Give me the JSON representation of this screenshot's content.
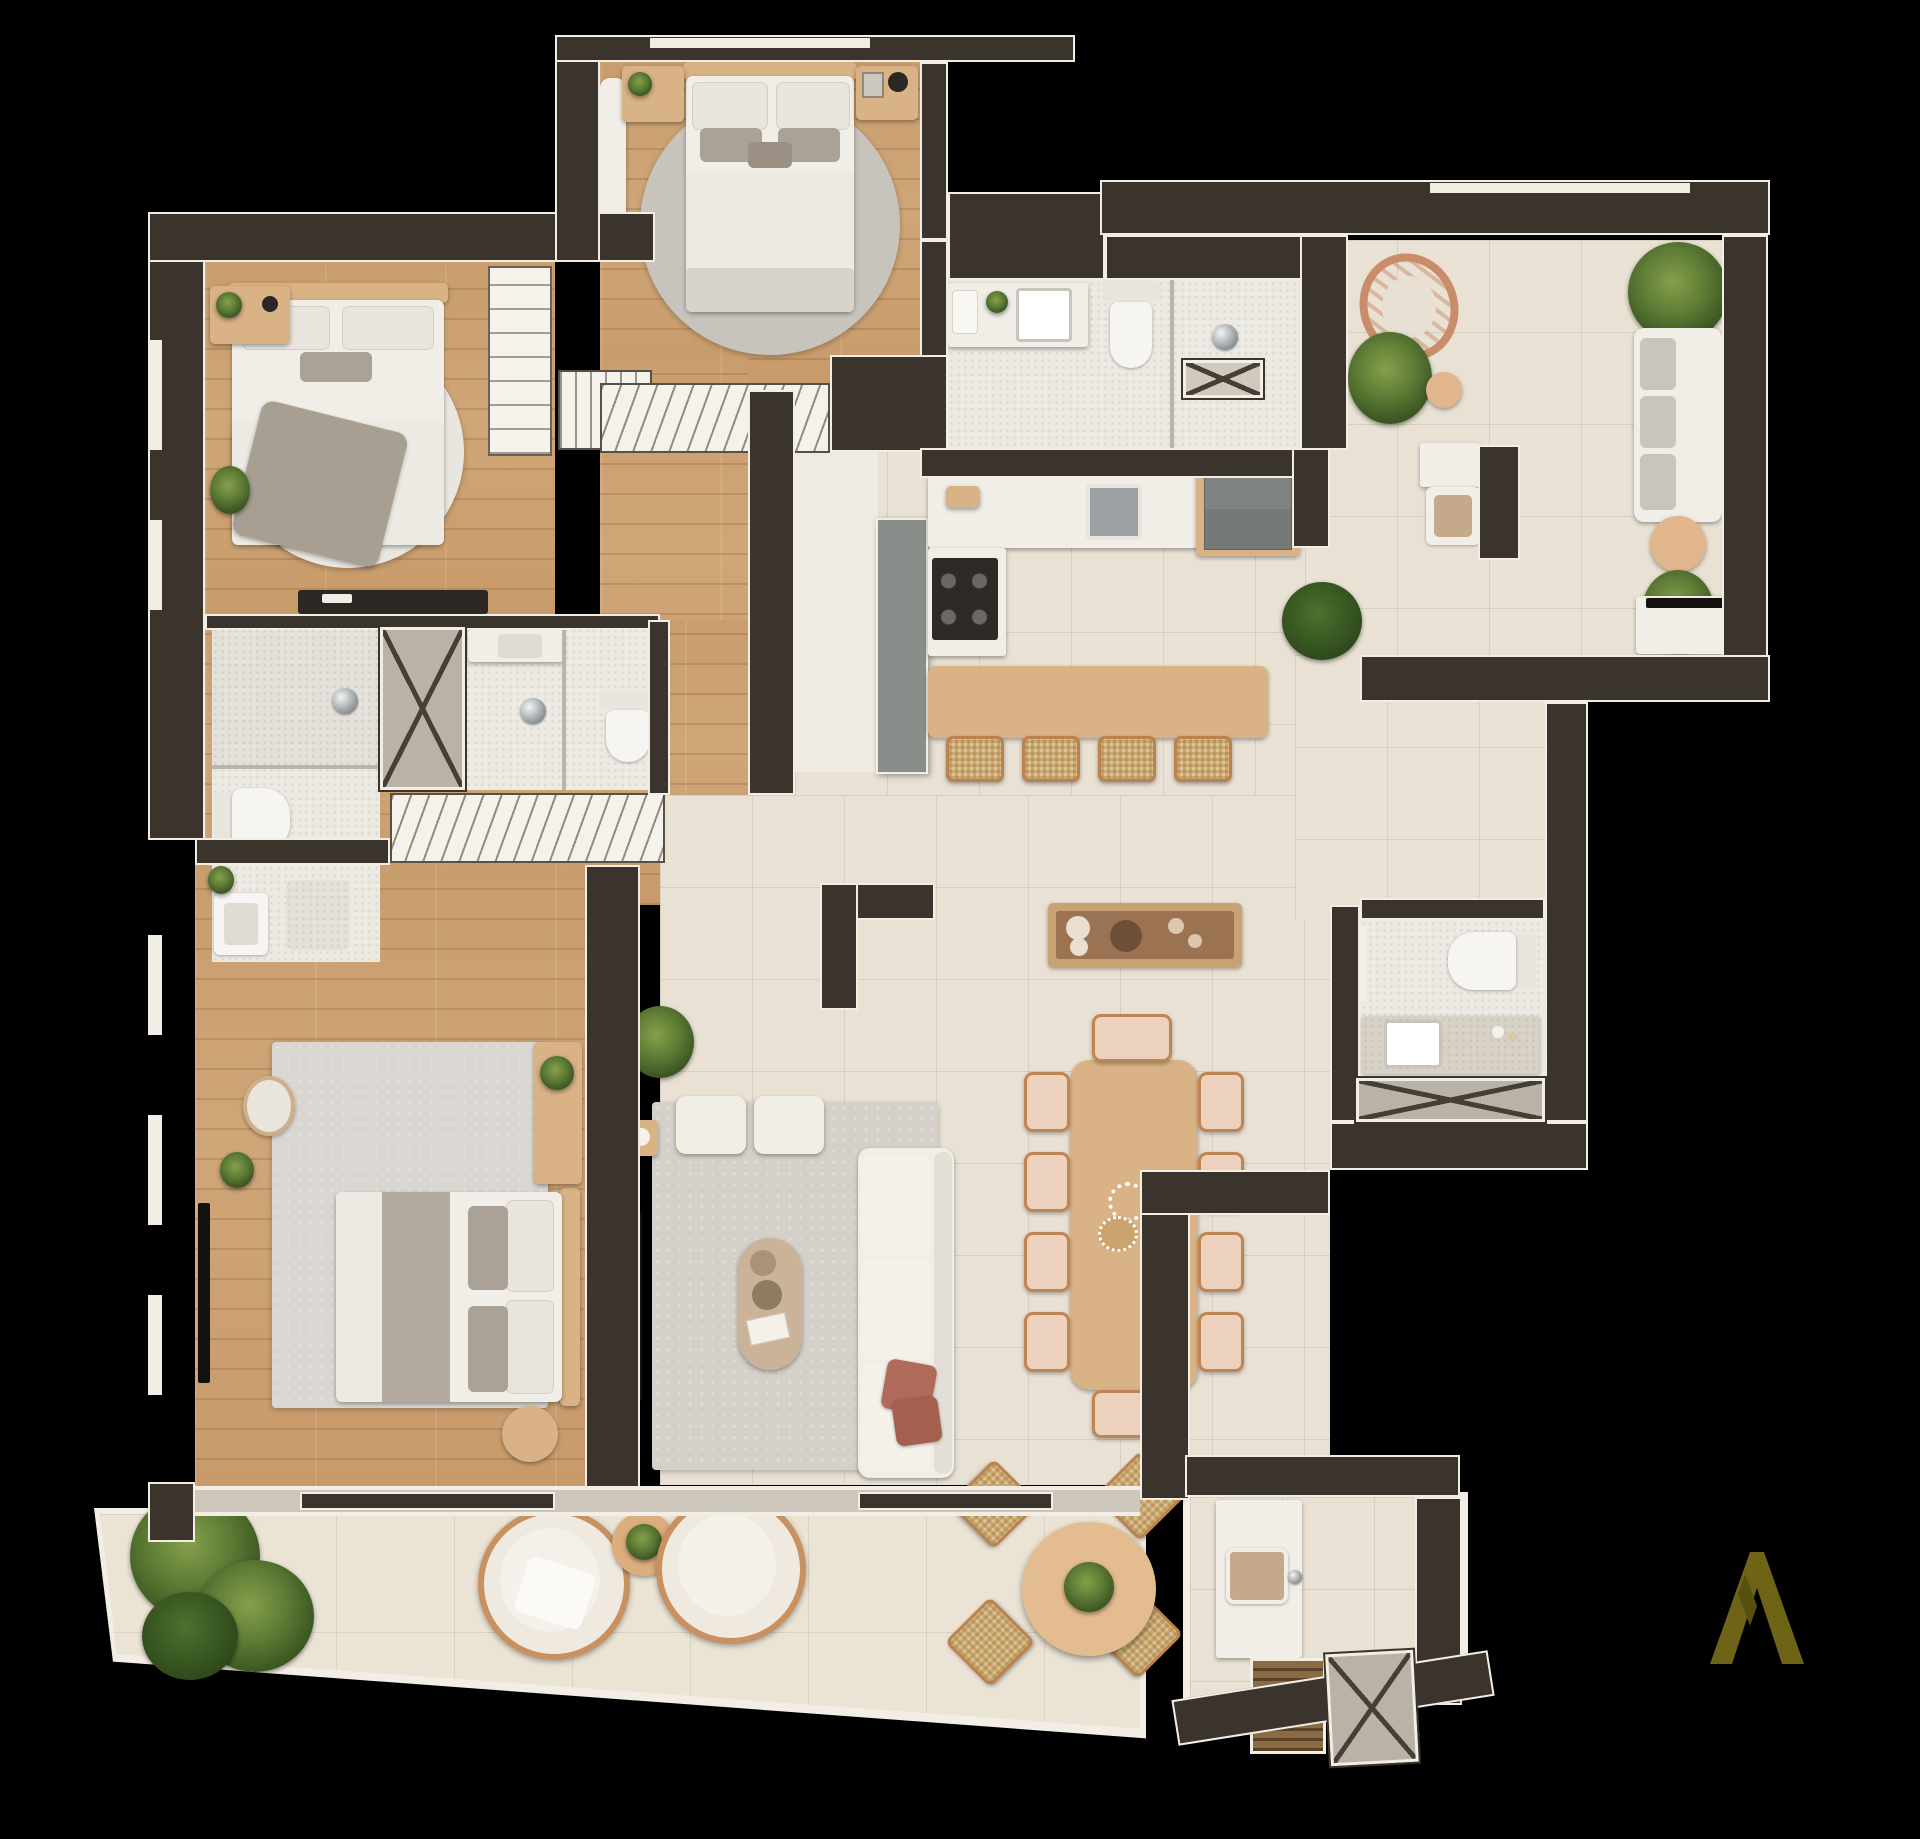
{
  "app": {
    "type": "architectural floor plan rendering",
    "style": "top-down 3D apartment plan on black background",
    "background_color": "#000000",
    "visible_text": "none"
  },
  "branding": {
    "logo_glyph": "A",
    "logo_color": "#6e6418",
    "logo_position": "bottom-right corner"
  },
  "palette": {
    "wall": "#3a342d",
    "wall_trim": "#f2eee6",
    "wood_floor": "#c99d6e",
    "tile_floor": "#e9e2d4",
    "bath_tile": "#edeae4",
    "terrace_tile": "#ebe4d5",
    "rug_light": "#e9e6e0",
    "rug_gray": "#c7c3bd",
    "furniture_wood": "#d9b286",
    "sofa_white": "#f1eee8",
    "accent_terracotta": "#b06a59",
    "plant_green": "#5d7c35",
    "appliance_gray": "#757a76",
    "chrome": "#9aa0a3",
    "louver_closet": "#f5f2ec"
  },
  "rooms": [
    {
      "id": "suite-1-bedroom",
      "name": "Suite 1 bedroom (top center)",
      "floor": "wood",
      "furniture": [
        "double bed with four pillows",
        "round gray rug",
        "left nightstand with plant",
        "right nightstand with lamp and frame",
        "wall bench",
        "built-in closet with hanging clothes"
      ]
    },
    {
      "id": "suite-2-bedroom",
      "name": "Suite 2 bedroom (top left)",
      "floor": "wood",
      "furniture": [
        "double bed with gray throw",
        "round light rug",
        "nightstand with plant and clock",
        "wall desk console",
        "built-in wardrobe shelves",
        "louvered closet",
        "floor plant"
      ]
    },
    {
      "id": "suite-2-bathroom",
      "name": "Suite 2 bathroom",
      "floor": "speckled tile",
      "furniture": [
        "walk-in shower",
        "toilet",
        "washbasin",
        "bath mat"
      ]
    },
    {
      "id": "suite-1-bathroom",
      "name": "Suite 1 bathroom",
      "floor": "speckled tile",
      "furniture": [
        "vanity washbasin",
        "walk-in shower",
        "toilet"
      ]
    },
    {
      "id": "central-shaft",
      "name": "Ventilation shaft",
      "floor": "none",
      "furniture": [
        "X-braced duct"
      ]
    },
    {
      "id": "hall-closet",
      "name": "Hallway wardrobe",
      "floor": "wood",
      "furniture": [
        "full-width closet with hangers"
      ]
    },
    {
      "id": "master-suite",
      "name": "Master suite bedroom (bottom left)",
      "floor": "wood",
      "furniture": [
        "king bed with gray runner",
        "large textured rug",
        "vanity desk with plant",
        "round pouf",
        "round side table",
        "wall TV",
        "floor plant"
      ]
    },
    {
      "id": "main-bathroom",
      "name": "Main bathroom (top right)",
      "floor": "speckled tile",
      "furniture": [
        "vanity with basin, towel and plant",
        "toilet",
        "glass shower",
        "X-front cabinet",
        "shower head"
      ]
    },
    {
      "id": "laundry-nook",
      "name": "Laundry nook",
      "floor": "tile",
      "furniture": [
        "utility sink",
        "counter"
      ]
    },
    {
      "id": "kitchen",
      "name": "Kitchen",
      "floor": "tile",
      "furniture": [
        "counter with steel sink",
        "4-burner cooktop",
        "double-door refrigerator",
        "tall gray cabinet",
        "wood breakfast island",
        "4 wicker stools"
      ]
    },
    {
      "id": "dining-area",
      "name": "Dining area",
      "floor": "tile",
      "furniture": [
        "10-seat wood dining table",
        "bead centerpiece",
        "wood buffet with dishes"
      ]
    },
    {
      "id": "living-room",
      "name": "Living room",
      "floor": "tile",
      "furniture": [
        "gray rug",
        "two white ottomans",
        "pill-shaped coffee table",
        "white sofa with terracotta pillows",
        "wall TV",
        "corner plant",
        "small side table",
        "L-shaped partition"
      ]
    },
    {
      "id": "sitting-room",
      "name": "Sitting / family room (top right)",
      "floor": "tile",
      "furniture": [
        "hanging rattan chair",
        "white sofa with gray cushions",
        "round coffee table",
        "TV console",
        "palm plants",
        "round side table",
        "green shrub"
      ]
    },
    {
      "id": "powder-room",
      "name": "Powder room (right)",
      "floor": "speckled tile",
      "furniture": [
        "toilet",
        "speckled counter with square basin",
        "X-braced shaft cabinet"
      ]
    },
    {
      "id": "terrace",
      "name": "Terrace / balcony (bottom)",
      "floor": "large tile",
      "furniture": [
        "palm plant cluster",
        "two round lounge chairs",
        "round side table with plant",
        "round outdoor dining table with plant",
        "4 wicker chairs",
        "sliding glass doors"
      ]
    },
    {
      "id": "gourmet-nook",
      "name": "Outdoor gourmet nook (bottom right)",
      "floor": "tile",
      "furniture": [
        "counter with sink",
        "barbecue grill",
        "X-braced service shaft"
      ]
    }
  ]
}
